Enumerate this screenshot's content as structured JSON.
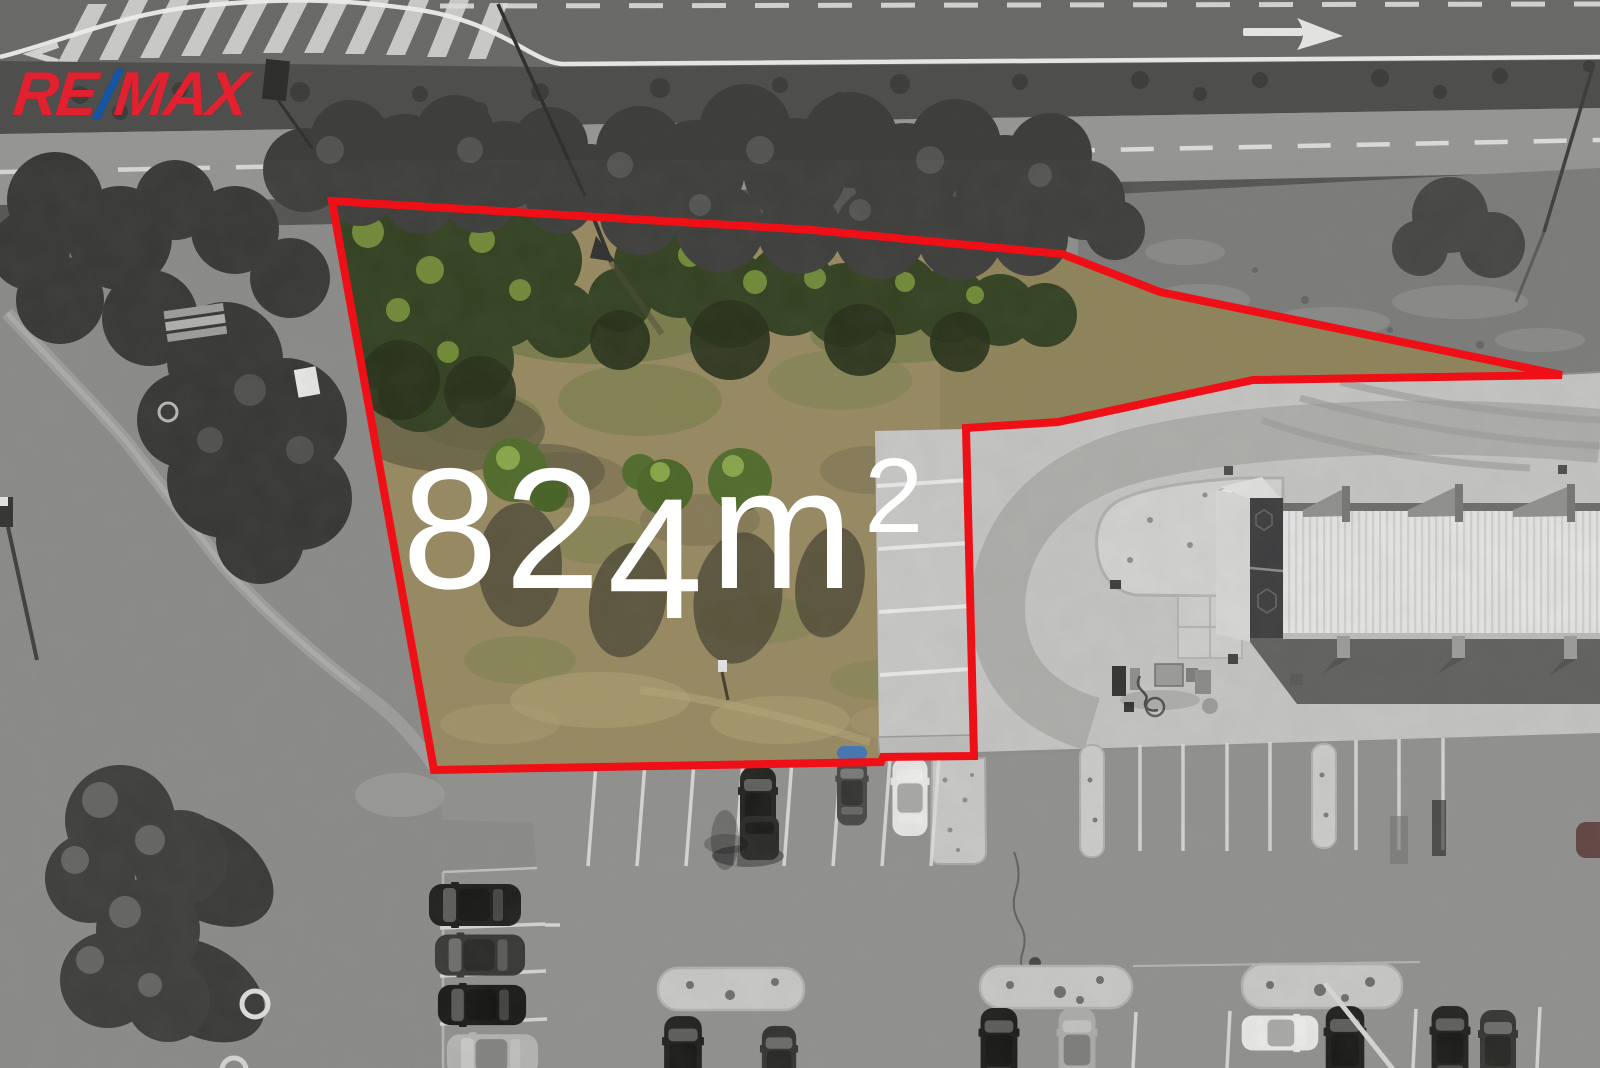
{
  "scene": {
    "type": "aerial-drone-photo-real-estate",
    "width_px": 1600,
    "height_px": 1068,
    "description": "Aerial photo of a land plot outlined in red; surroundings desaturated, plot in color"
  },
  "branding": {
    "re": "RE",
    "slash": "/",
    "max": "MAX",
    "red": "#e1212f",
    "blue": "#1356a8"
  },
  "plot": {
    "area_label": "824m²",
    "area_main": "82",
    "area_digit_down": "4",
    "area_unit": "m",
    "area_superscript": "2",
    "text_color": "#ffffff",
    "boundary_color": "#ee1016",
    "boundary_points": "332,201 812,230 1062,254 1160,292 1562,375 1253,380 1058,422 966,428 974,756 883,757 881,762 434,770"
  }
}
